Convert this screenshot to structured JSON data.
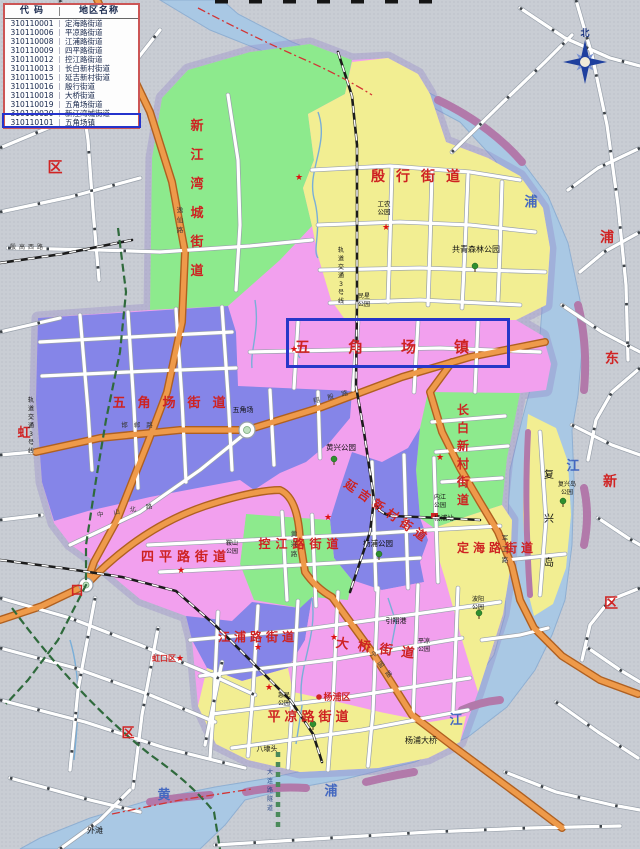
{
  "legend": {
    "headers": [
      "代 码",
      "地区名称"
    ],
    "rows": [
      [
        "310110001",
        "定海路街道"
      ],
      [
        "310110006",
        "平凉路街道"
      ],
      [
        "310110008",
        "江浦路街道"
      ],
      [
        "310110009",
        "四平路街道"
      ],
      [
        "310110012",
        "控江路街道"
      ],
      [
        "310110013",
        "长白新村街道"
      ],
      [
        "310110015",
        "延吉新村街道"
      ],
      [
        "310110016",
        "殷行街道"
      ],
      [
        "310110018",
        "大桥街道"
      ],
      [
        "310110019",
        "五角场街道"
      ],
      [
        "310110020",
        "新江湾城街道"
      ],
      [
        "310110101",
        "五角场镇"
      ]
    ],
    "highlighted_row_index": 11
  },
  "map": {
    "highlighted_area": "五角场镇",
    "compass_label": "北",
    "colors": {
      "outside_gray": "#c9cdd4",
      "river_blue": "#a9c8e4",
      "region_green": "#8dea8d",
      "region_yellow": "#f2ee92",
      "region_pink": "#f2a0ee",
      "region_purple": "#8585e8",
      "orange_road": "#ee9a4a",
      "highlight_blue": "#2737c8",
      "legend_border_red": "#cc5555",
      "label_red": "#ce2222"
    },
    "regions": [
      {
        "name": "district-base-wujiaochang-town",
        "color": "#f2a0ee"
      },
      {
        "name": "xinjiangwancheng-subdistrict",
        "color": "#8dea8d"
      },
      {
        "name": "yinhang-subdistrict",
        "color": "#f2ee92"
      },
      {
        "name": "wujiaochang-subdistrict",
        "color": "#8585e8"
      },
      {
        "name": "changbai-xincun-subdistrict",
        "color": "#8dea8d"
      },
      {
        "name": "yanji-xincun-subdistrict",
        "color": "#8585e8"
      },
      {
        "name": "kongjiang-road-subdistrict",
        "color": "#8dea8d"
      },
      {
        "name": "siping-road-subdistrict",
        "color": "#f2a0ee"
      },
      {
        "name": "jiangpu-road-subdistrict",
        "color": "#8585e8"
      },
      {
        "name": "daqiao-subdistrict",
        "color": "#f2a0ee"
      },
      {
        "name": "pingliang-road-subdistrict",
        "color": "#f2ee92"
      },
      {
        "name": "dinghai-road-subdistrict",
        "color": "#f2ee92"
      },
      {
        "name": "fuxing-island",
        "color": "#f2ee92"
      }
    ],
    "labels": [
      {
        "t": "新江湾城街道",
        "x": 197,
        "y": 130,
        "fs": 13,
        "v": 1,
        "g": 29,
        "c": "rg"
      },
      {
        "t": "殷行街道",
        "x": 421,
        "y": 181,
        "fs": 14,
        "ls": 11,
        "c": "rg"
      },
      {
        "t": "五角场镇",
        "x": 401,
        "y": 352,
        "fs": 15,
        "ls": 38,
        "c": "rg"
      },
      {
        "t": "五角场街道",
        "x": 175,
        "y": 407,
        "fs": 13,
        "ls": 12,
        "c": "rg"
      },
      {
        "t": "长白新村街道",
        "x": 463,
        "y": 414,
        "fs": 12,
        "v": 1,
        "g": 18,
        "c": "rg"
      },
      {
        "t": "延吉新村街道",
        "x": 385,
        "y": 515,
        "fs": 12,
        "ls": 5,
        "rot": 35,
        "c": "rg"
      },
      {
        "t": "控江路街道",
        "x": 301,
        "y": 548,
        "fs": 12,
        "ls": 5,
        "c": "rg"
      },
      {
        "t": "四平路街道",
        "x": 186,
        "y": 561,
        "fs": 13,
        "ls": 5,
        "c": "rg"
      },
      {
        "t": "江浦路街道",
        "x": 258,
        "y": 641,
        "fs": 12,
        "ls": 4,
        "c": "rg"
      },
      {
        "t": "大桥街道",
        "x": 379,
        "y": 653,
        "fs": 13,
        "ls": 9,
        "rot": 8,
        "c": "rg"
      },
      {
        "t": "平凉路街道",
        "x": 310,
        "y": 721,
        "fs": 13,
        "ls": 4,
        "c": "rg"
      },
      {
        "t": "定海路街道",
        "x": 497,
        "y": 552,
        "fs": 12,
        "ls": 4,
        "c": "rg"
      },
      {
        "t": "区",
        "x": 55,
        "y": 172,
        "fs": 15,
        "c": "rd"
      },
      {
        "t": "虹",
        "x": 24,
        "y": 437,
        "fs": 13,
        "c": "rd"
      },
      {
        "t": "口",
        "x": 77,
        "y": 595,
        "fs": 13,
        "c": "rd"
      },
      {
        "t": "区",
        "x": 128,
        "y": 737,
        "fs": 13,
        "c": "rd"
      },
      {
        "t": "浦",
        "x": 607,
        "y": 242,
        "fs": 14,
        "c": "rd"
      },
      {
        "t": "东",
        "x": 612,
        "y": 363,
        "fs": 14,
        "c": "rd"
      },
      {
        "t": "新",
        "x": 610,
        "y": 486,
        "fs": 14,
        "c": "rd"
      },
      {
        "t": "区",
        "x": 611,
        "y": 608,
        "fs": 14,
        "c": "rd"
      },
      {
        "t": "虹口区",
        "x": 164,
        "y": 661,
        "fs": 8,
        "c": "rd"
      },
      {
        "t": "杨浦区",
        "x": 337,
        "y": 700,
        "fs": 9,
        "c": "rd"
      },
      {
        "t": "浦",
        "x": 531,
        "y": 206,
        "fs": 13,
        "c": "rv"
      },
      {
        "t": "江",
        "x": 573,
        "y": 470,
        "fs": 13,
        "c": "rv"
      },
      {
        "t": "江",
        "x": 456,
        "y": 724,
        "fs": 13,
        "c": "rv"
      },
      {
        "t": "浦",
        "x": 331,
        "y": 795,
        "fs": 13,
        "c": "rv"
      },
      {
        "t": "黄",
        "x": 164,
        "y": 799,
        "fs": 13,
        "c": "rv"
      },
      {
        "t": "工农",
        "x": 384,
        "y": 206,
        "fs": 6.5,
        "c": "pk"
      },
      {
        "t": "公园",
        "x": 384,
        "y": 214,
        "fs": 6.5,
        "c": "pk"
      },
      {
        "t": "共青森林公园",
        "x": 476,
        "y": 252,
        "fs": 8,
        "c": "pk"
      },
      {
        "t": "民星",
        "x": 364,
        "y": 298,
        "fs": 6,
        "c": "pk"
      },
      {
        "t": "公园",
        "x": 364,
        "y": 306,
        "fs": 6,
        "c": "pk"
      },
      {
        "t": "黄兴公园",
        "x": 341,
        "y": 450,
        "fs": 7.5,
        "c": "pk"
      },
      {
        "t": "杨浦公园",
        "x": 378,
        "y": 546,
        "fs": 7.5,
        "c": "pk"
      },
      {
        "t": "内江",
        "x": 440,
        "y": 499,
        "fs": 6,
        "c": "pk"
      },
      {
        "t": "公园",
        "x": 440,
        "y": 507,
        "fs": 6,
        "c": "pk"
      },
      {
        "t": "复兴岛",
        "x": 567,
        "y": 486,
        "fs": 6,
        "c": "pk"
      },
      {
        "t": "公园",
        "x": 567,
        "y": 494,
        "fs": 6,
        "c": "pk"
      },
      {
        "t": "鞍山",
        "x": 232,
        "y": 545,
        "fs": 6,
        "c": "pk"
      },
      {
        "t": "公园",
        "x": 232,
        "y": 553,
        "fs": 6,
        "c": "pk"
      },
      {
        "t": "波阳",
        "x": 478,
        "y": 601,
        "fs": 6,
        "c": "pk"
      },
      {
        "t": "公园",
        "x": 478,
        "y": 609,
        "fs": 6,
        "c": "pk"
      },
      {
        "t": "平凉",
        "x": 424,
        "y": 643,
        "fs": 6,
        "c": "pk"
      },
      {
        "t": "公园",
        "x": 424,
        "y": 651,
        "fs": 6,
        "c": "pk"
      },
      {
        "t": "惠民",
        "x": 284,
        "y": 697,
        "fs": 6,
        "c": "pk"
      },
      {
        "t": "公园",
        "x": 284,
        "y": 705,
        "fs": 6,
        "c": "pk"
      },
      {
        "t": "引翔港",
        "x": 396,
        "y": 623,
        "fs": 7,
        "c": "pk"
      },
      {
        "t": "杨浦大桥",
        "x": 421,
        "y": 743,
        "fs": 8,
        "c": "pk"
      },
      {
        "t": "八埭头",
        "x": 267,
        "y": 751,
        "fs": 7,
        "c": "pk"
      },
      {
        "t": "外滩",
        "x": 95,
        "y": 833,
        "fs": 8,
        "c": "pk"
      },
      {
        "t": "五角场",
        "x": 243,
        "y": 412,
        "fs": 7,
        "c": "pk"
      },
      {
        "t": "杨浦站",
        "x": 444,
        "y": 520,
        "fs": 6.5,
        "c": "pk"
      },
      {
        "t": "复兴岛",
        "x": 549,
        "y": 478,
        "fs": 10,
        "v": 1,
        "g": 44,
        "c": "pk"
      },
      {
        "t": "轨道交通3号线",
        "x": 341,
        "y": 252,
        "fs": 6,
        "v": 1,
        "g": 8.5,
        "c": "pk"
      },
      {
        "t": "轨道交通3号线",
        "x": 31,
        "y": 402,
        "fs": 6,
        "v": 1,
        "g": 8.5,
        "c": "pk"
      },
      {
        "t": "大连路隧道",
        "x": 270,
        "y": 774,
        "fs": 6,
        "v": 1,
        "g": 9,
        "c": "tn"
      },
      {
        "t": "逸仙路",
        "x": 180,
        "y": 212,
        "fs": 6.5,
        "v": 1,
        "g": 10,
        "c": "ro"
      },
      {
        "t": "邯郸路",
        "x": 140,
        "y": 427,
        "fs": 6.5,
        "ls": 6,
        "c": "ro"
      },
      {
        "t": "翔殷路",
        "x": 335,
        "y": 398,
        "fs": 6.5,
        "ls": 8,
        "rot": -14,
        "c": "ro"
      },
      {
        "t": "中山北路",
        "x": 130,
        "y": 512,
        "fs": 6.5,
        "ls": 10,
        "rot": -9,
        "c": "ro"
      },
      {
        "t": "军工路",
        "x": 505,
        "y": 540,
        "fs": 6.5,
        "v": 1,
        "g": 11,
        "c": "ro"
      },
      {
        "t": "黄兴路",
        "x": 294,
        "y": 536,
        "fs": 6.5,
        "v": 1,
        "g": 10,
        "c": "ro"
      },
      {
        "t": "宁国路",
        "x": 381,
        "y": 668,
        "fs": 6.5,
        "ls": 6,
        "rot": 52,
        "c": "ro"
      },
      {
        "t": "殷高西路",
        "x": 28,
        "y": 249,
        "fs": 6,
        "ls": 3,
        "c": "ro"
      },
      {
        "t": "北",
        "x": 585,
        "y": 36,
        "fs": 9,
        "c": "cp"
      }
    ],
    "stars": [
      [
        299,
        177
      ],
      [
        386,
        227
      ],
      [
        294,
        349
      ],
      [
        440,
        457
      ],
      [
        328,
        517
      ],
      [
        181,
        570
      ],
      [
        258,
        647
      ],
      [
        334,
        637
      ],
      [
        269,
        687
      ],
      [
        180,
        658
      ]
    ],
    "trees": [
      [
        475,
        266
      ],
      [
        334,
        459
      ],
      [
        379,
        554
      ],
      [
        479,
        613
      ],
      [
        563,
        501
      ],
      [
        313,
        724
      ]
    ]
  }
}
